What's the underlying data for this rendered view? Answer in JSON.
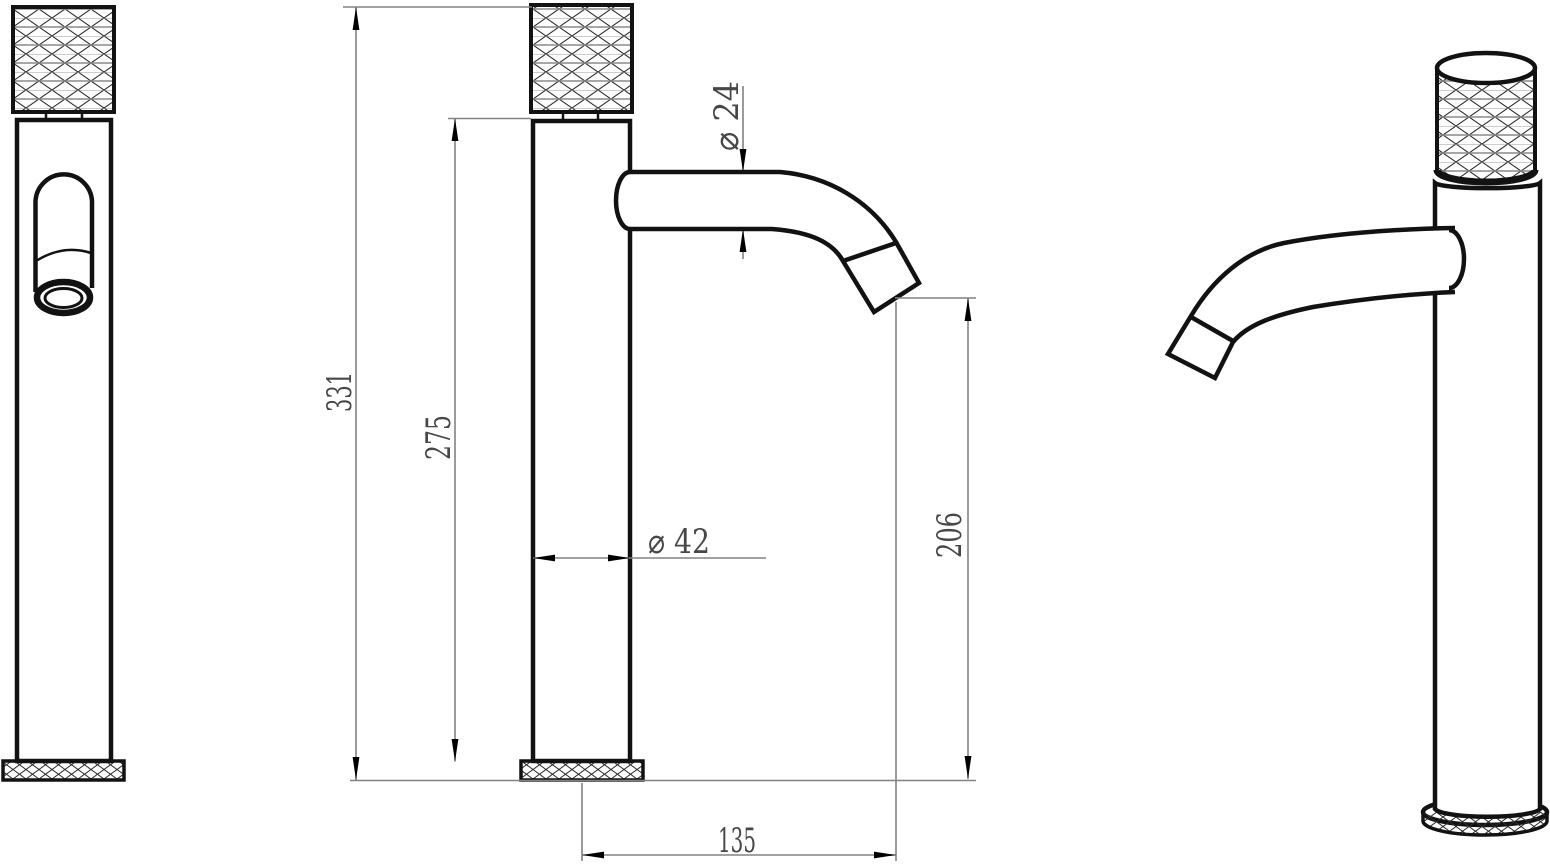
{
  "drawing": {
    "title": "basin-faucet-three-view-technical-drawing",
    "dims": {
      "overall_height": "331",
      "body_height": "275",
      "spout_diameter": "⌀ 24",
      "body_diameter": "⌀ 42",
      "outlet_height": "206",
      "spout_reach": "135"
    },
    "colors": {
      "line": "#121212",
      "dimension_line": "#828282",
      "dimension_text": "#474747",
      "background": "#ffffff"
    }
  }
}
